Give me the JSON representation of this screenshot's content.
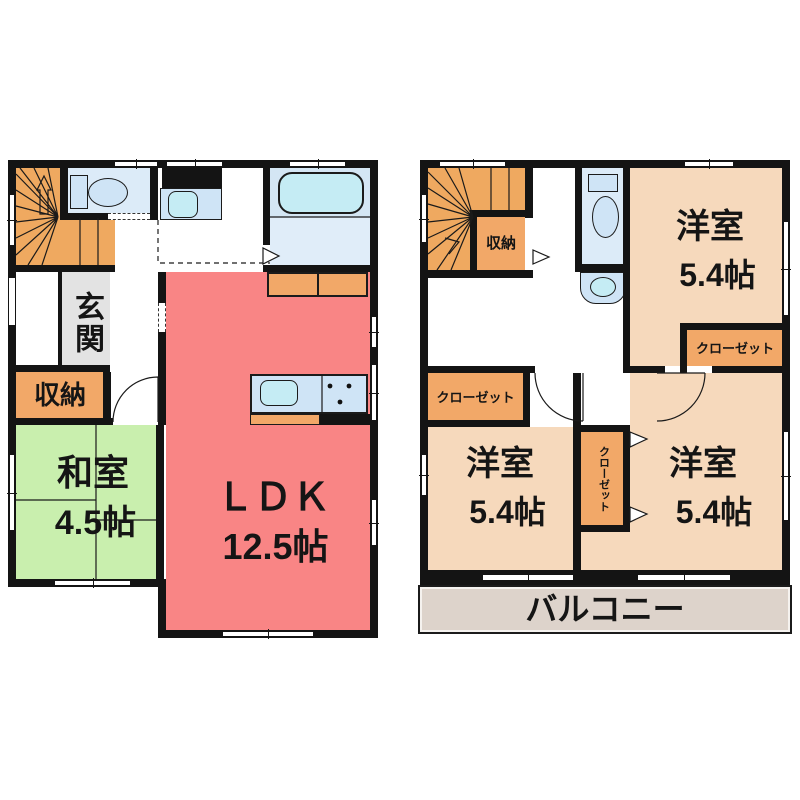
{
  "title": "2-story house floor plan",
  "colors": {
    "wall": "#141414",
    "stairs_orange": "#efa960",
    "storage_orange": "#f2a868",
    "washitsu_green": "#c9efae",
    "ldk_red": "#f98585",
    "youshitsu_tan": "#f6d9bc",
    "balcony_gray": "#ddd3cb",
    "genkan_gray": "#e3e3e3",
    "water_floor": "#dcebf8",
    "bath_floor": "#d4e6f4",
    "bath_floor_light": "#e0edf9",
    "fixture_fill": "#cfe4f6",
    "basin_cyan": "#c5ecf4"
  },
  "floor1": {
    "genkan_label": "玄関",
    "storage_label": "収納",
    "washitsu_name": "和室",
    "washitsu_size": "4.5帖",
    "ldk_name": "ＬＤＫ",
    "ldk_size": "12.5帖"
  },
  "floor2": {
    "storage_label": "収納",
    "room_ne_name": "洋室",
    "room_ne_size": "5.4帖",
    "closet_ne_label": "クローゼット",
    "closet_w_label": "クローゼット",
    "closet_mid_label": "クローゼット",
    "room_sw_name": "洋室",
    "room_sw_size": "5.4帖",
    "room_se_name": "洋室",
    "room_se_size": "5.4帖",
    "balcony_label": "バルコニー"
  }
}
